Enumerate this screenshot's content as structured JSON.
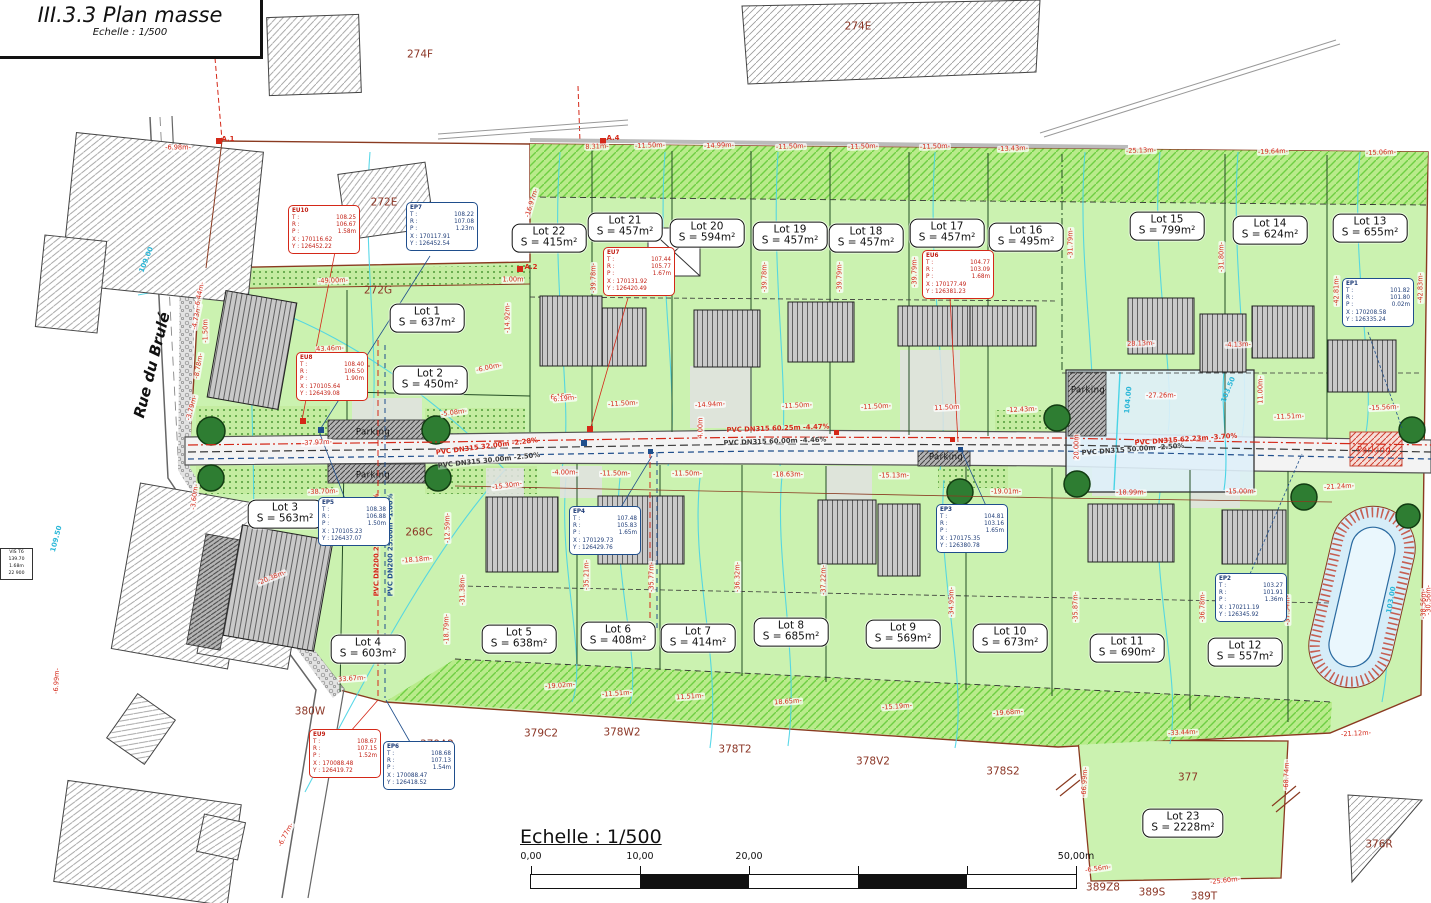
{
  "title_block": {
    "title": "III.3.3 Plan masse",
    "subtitle": "Echelle : 1/500"
  },
  "street": {
    "name": "Rue du Brulé"
  },
  "scale_bar": {
    "label": "Echelle : 1/500",
    "ticks": [
      {
        "t": "0,00",
        "p": 0
      },
      {
        "t": "10,00",
        "p": 109
      },
      {
        "t": "20,00",
        "p": 218
      },
      {
        "t": "50,00m",
        "p": 545
      }
    ]
  },
  "ref_box": {
    "lines": [
      "VIS T6",
      "139.70",
      "1.68m",
      "22 900"
    ]
  },
  "colors": {
    "lot_green": "#cbf2b0",
    "hatch_green": "#b9eb8b",
    "water": "#dff0f9",
    "red": "#d42818",
    "navy": "#1f4e8c",
    "parcel_brown": "#8b3525",
    "contour_cyan": "#49d4e6",
    "boundary": "#8a3a20"
  },
  "lots": [
    {
      "name": "Lot 1",
      "area": "S = 637m²",
      "x": 427,
      "y": 318
    },
    {
      "name": "Lot 2",
      "area": "S = 450m²",
      "x": 430,
      "y": 380
    },
    {
      "name": "Lot 3",
      "area": "S = 563m²",
      "x": 285,
      "y": 514
    },
    {
      "name": "Lot 4",
      "area": "S = 603m²",
      "x": 368,
      "y": 649
    },
    {
      "name": "Lot 5",
      "area": "S = 638m²",
      "x": 519,
      "y": 639
    },
    {
      "name": "Lot 6",
      "area": "S = 408m²",
      "x": 618,
      "y": 636
    },
    {
      "name": "Lot 7",
      "area": "S = 414m²",
      "x": 698,
      "y": 638
    },
    {
      "name": "Lot 8",
      "area": "S = 685m²",
      "x": 791,
      "y": 632
    },
    {
      "name": "Lot 9",
      "area": "S = 569m²",
      "x": 903,
      "y": 634
    },
    {
      "name": "Lot 10",
      "area": "S = 673m²",
      "x": 1010,
      "y": 638
    },
    {
      "name": "Lot 11",
      "area": "S = 690m²",
      "x": 1127,
      "y": 648
    },
    {
      "name": "Lot 12",
      "area": "S = 557m²",
      "x": 1245,
      "y": 652
    },
    {
      "name": "Lot 13",
      "area": "S = 655m²",
      "x": 1370,
      "y": 228
    },
    {
      "name": "Lot 14",
      "area": "S = 624m²",
      "x": 1270,
      "y": 230
    },
    {
      "name": "Lot 15",
      "area": "S = 799m²",
      "x": 1167,
      "y": 226
    },
    {
      "name": "Lot 16",
      "area": "S = 495m²",
      "x": 1026,
      "y": 237
    },
    {
      "name": "Lot 17",
      "area": "S = 457m²",
      "x": 947,
      "y": 233
    },
    {
      "name": "Lot 18",
      "area": "S = 457m²",
      "x": 866,
      "y": 238
    },
    {
      "name": "Lot 19",
      "area": "S = 457m²",
      "x": 790,
      "y": 236
    },
    {
      "name": "Lot 20",
      "area": "S = 594m²",
      "x": 707,
      "y": 233
    },
    {
      "name": "Lot 21",
      "area": "S = 457m²",
      "x": 625,
      "y": 227
    },
    {
      "name": "Lot 22",
      "area": "S = 415m²",
      "x": 549,
      "y": 238
    },
    {
      "name": "Lot 23",
      "area": "S = 2228m²",
      "x": 1183,
      "y": 823
    }
  ],
  "parcels": [
    {
      "t": "274F",
      "x": 420,
      "y": 55
    },
    {
      "t": "274E",
      "x": 858,
      "y": 27
    },
    {
      "t": "272E",
      "x": 384,
      "y": 203
    },
    {
      "t": "272G",
      "x": 378,
      "y": 291
    },
    {
      "t": "271L",
      "x": 357,
      "y": 364
    },
    {
      "t": "268C",
      "x": 419,
      "y": 533
    },
    {
      "t": "380W",
      "x": 310,
      "y": 712
    },
    {
      "t": "379A2",
      "x": 437,
      "y": 745
    },
    {
      "t": "379C2",
      "x": 541,
      "y": 734
    },
    {
      "t": "378W2",
      "x": 622,
      "y": 733
    },
    {
      "t": "378T2",
      "x": 735,
      "y": 750
    },
    {
      "t": "378V2",
      "x": 873,
      "y": 762
    },
    {
      "t": "378S2",
      "x": 1003,
      "y": 772
    },
    {
      "t": "377",
      "x": 1188,
      "y": 778
    },
    {
      "t": "389Z8",
      "x": 1103,
      "y": 888
    },
    {
      "t": "389S",
      "x": 1152,
      "y": 893
    },
    {
      "t": "389T",
      "x": 1204,
      "y": 897
    },
    {
      "t": "376R",
      "x": 1379,
      "y": 845
    }
  ],
  "survey_points": [
    {
      "id": "EU10",
      "kind": "eu",
      "x": 288,
      "y": 205,
      "T": "108.25",
      "R": "106.67",
      "P": "1.58m",
      "X": "170116.62",
      "Y": "126452.22"
    },
    {
      "id": "EP7",
      "kind": "ep",
      "x": 406,
      "y": 202,
      "T": "108.22",
      "R": "107.08",
      "P": "1.23m",
      "X": "170117.91",
      "Y": "126452.54"
    },
    {
      "id": "EU8",
      "kind": "eu",
      "x": 296,
      "y": 352,
      "T": "108.40",
      "R": "106.50",
      "P": "1.90m",
      "X": "170105.64",
      "Y": "126439.08"
    },
    {
      "id": "EU7",
      "kind": "eu",
      "x": 603,
      "y": 247,
      "T": "107.44",
      "R": "105.77",
      "P": "1.67m",
      "X": "170131.92",
      "Y": "126420.49"
    },
    {
      "id": "EU6",
      "kind": "eu",
      "x": 922,
      "y": 250,
      "T": "104.77",
      "R": "103.09",
      "P": "1.68m",
      "X": "170177.49",
      "Y": "126381.23"
    },
    {
      "id": "EP1",
      "kind": "ep",
      "x": 1342,
      "y": 278,
      "T": "101.82",
      "R": "101.80",
      "P": "0.02m",
      "X": "170208.58",
      "Y": "126335.24"
    },
    {
      "id": "EP5",
      "kind": "ep",
      "x": 318,
      "y": 497,
      "T": "108.38",
      "R": "106.88",
      "P": "1.50m",
      "X": "170105.23",
      "Y": "126437.07"
    },
    {
      "id": "EP4",
      "kind": "ep",
      "x": 569,
      "y": 506,
      "T": "107.48",
      "R": "105.83",
      "P": "1.65m",
      "X": "170129.73",
      "Y": "126429.76"
    },
    {
      "id": "EP3",
      "kind": "ep",
      "x": 936,
      "y": 504,
      "T": "104.81",
      "R": "103.16",
      "P": "1.65m",
      "X": "170175.35",
      "Y": "126380.78"
    },
    {
      "id": "EP2",
      "kind": "ep",
      "x": 1215,
      "y": 573,
      "T": "103.27",
      "R": "101.91",
      "P": "1.36m",
      "X": "170211.19",
      "Y": "126345.92"
    },
    {
      "id": "EU9",
      "kind": "eu",
      "x": 309,
      "y": 729,
      "T": "108.67",
      "R": "107.15",
      "P": "1.52m",
      "X": "170088.48",
      "Y": "126419.72"
    },
    {
      "id": "EP6",
      "kind": "ep",
      "x": 383,
      "y": 741,
      "T": "108.68",
      "R": "107.13",
      "P": "1.54m",
      "X": "170088.47",
      "Y": "126418.52"
    }
  ],
  "dimensions": [
    {
      "t": "-6.98m-",
      "x": 178,
      "y": 148,
      "r": 0
    },
    {
      "t": "8.31m-",
      "x": 597,
      "y": 147,
      "r": -2
    },
    {
      "t": "-11.50m-",
      "x": 650,
      "y": 146,
      "r": -2
    },
    {
      "t": "-14.99m-",
      "x": 719,
      "y": 146,
      "r": -2
    },
    {
      "t": "-11.50m-",
      "x": 791,
      "y": 147,
      "r": -2
    },
    {
      "t": "-11.50m-",
      "x": 863,
      "y": 147,
      "r": -2
    },
    {
      "t": "-11.50m-",
      "x": 935,
      "y": 147,
      "r": -2
    },
    {
      "t": "-13.43m-",
      "x": 1013,
      "y": 149,
      "r": -2
    },
    {
      "t": "-25.13m-",
      "x": 1141,
      "y": 151,
      "r": -2
    },
    {
      "t": "-19.64m-",
      "x": 1273,
      "y": 152,
      "r": -2
    },
    {
      "t": "-15.06m-",
      "x": 1381,
      "y": 153,
      "r": -2
    },
    {
      "t": "-49.00m-",
      "x": 333,
      "y": 281,
      "r": -2
    },
    {
      "t": "1.00m",
      "x": 513,
      "y": 280,
      "r": 0
    },
    {
      "t": "43.46m-",
      "x": 330,
      "y": 349,
      "r": -3
    },
    {
      "t": "-16.97m-",
      "x": 532,
      "y": 203,
      "r": -73
    },
    {
      "t": "-14.92m-",
      "x": 508,
      "y": 318,
      "r": -90
    },
    {
      "t": "-37.97m-",
      "x": 317,
      "y": 443,
      "r": -3
    },
    {
      "t": "-38.70m-",
      "x": 323,
      "y": 492,
      "r": -2
    },
    {
      "t": "-6.00m-",
      "x": 489,
      "y": 368,
      "r": -12
    },
    {
      "t": "6.15m",
      "x": 561,
      "y": 397,
      "r": -5
    },
    {
      "t": "-5.08m-",
      "x": 454,
      "y": 413,
      "r": -8
    },
    {
      "t": "-1.50m",
      "x": 206,
      "y": 331,
      "r": -90
    },
    {
      "t": "-4.73m-",
      "x": 197,
      "y": 317,
      "r": -78
    },
    {
      "t": "-6.44m-",
      "x": 200,
      "y": 295,
      "r": -78
    },
    {
      "t": "-8.78m-",
      "x": 199,
      "y": 366,
      "r": -80
    },
    {
      "t": "-3.79m-",
      "x": 192,
      "y": 408,
      "r": -75
    },
    {
      "t": "-3.60m-",
      "x": 195,
      "y": 497,
      "r": -83
    },
    {
      "t": "-6.99m-",
      "x": 57,
      "y": 681,
      "r": -87
    },
    {
      "t": "-6.77m-",
      "x": 286,
      "y": 835,
      "r": -62
    },
    {
      "t": "-15.30m-",
      "x": 507,
      "y": 486,
      "r": -8
    },
    {
      "t": "-4.00m-",
      "x": 565,
      "y": 473,
      "r": 0
    },
    {
      "t": "-11.50m-",
      "x": 615,
      "y": 474,
      "r": 0
    },
    {
      "t": "-11.50m-",
      "x": 687,
      "y": 474,
      "r": 0
    },
    {
      "t": "-18.63m-",
      "x": 788,
      "y": 475,
      "r": 0
    },
    {
      "t": "-15.13m-",
      "x": 894,
      "y": 476,
      "r": 0
    },
    {
      "t": "-19.01m-",
      "x": 1006,
      "y": 492,
      "r": 0
    },
    {
      "t": "-18.99m-",
      "x": 1131,
      "y": 493,
      "r": 0
    },
    {
      "t": "-15.00m-",
      "x": 1241,
      "y": 492,
      "r": 0
    },
    {
      "t": "6.19m-",
      "x": 565,
      "y": 399,
      "r": -5
    },
    {
      "t": "-11.50m-",
      "x": 623,
      "y": 404,
      "r": -3
    },
    {
      "t": "-14.94m-",
      "x": 710,
      "y": 405,
      "r": -3
    },
    {
      "t": "-11.50m-",
      "x": 797,
      "y": 406,
      "r": -3
    },
    {
      "t": "-11.50m-",
      "x": 876,
      "y": 407,
      "r": -3
    },
    {
      "t": "11.50m",
      "x": 947,
      "y": 408,
      "r": -3
    },
    {
      "t": "-12.43m-",
      "x": 1022,
      "y": 410,
      "r": -3
    },
    {
      "t": "4.00m",
      "x": 701,
      "y": 428,
      "r": -90
    },
    {
      "t": "-39.78m-",
      "x": 594,
      "y": 278,
      "r": -90
    },
    {
      "t": "-39.77m-",
      "x": 669,
      "y": 276,
      "r": -90
    },
    {
      "t": "-39.78m-",
      "x": 765,
      "y": 277,
      "r": -90
    },
    {
      "t": "-39.79m-",
      "x": 840,
      "y": 277,
      "r": -90
    },
    {
      "t": "-39.79m-",
      "x": 915,
      "y": 272,
      "r": -90
    },
    {
      "t": "-39.79m-",
      "x": 979,
      "y": 272,
      "r": -90
    },
    {
      "t": "-31.79m-",
      "x": 1071,
      "y": 243,
      "r": -90
    },
    {
      "t": "-31.80m-",
      "x": 1222,
      "y": 257,
      "r": -90
    },
    {
      "t": "-42.81m-",
      "x": 1337,
      "y": 291,
      "r": -90
    },
    {
      "t": "-42.83m-",
      "x": 1421,
      "y": 288,
      "r": -90
    },
    {
      "t": "-35.21m-",
      "x": 587,
      "y": 575,
      "r": -90
    },
    {
      "t": "-35.77m-",
      "x": 652,
      "y": 577,
      "r": -90
    },
    {
      "t": "-36.32m-",
      "x": 738,
      "y": 577,
      "r": -90
    },
    {
      "t": "-37.22m-",
      "x": 824,
      "y": 580,
      "r": -90
    },
    {
      "t": "-34.95m-",
      "x": 952,
      "y": 602,
      "r": -90
    },
    {
      "t": "-35.87m-",
      "x": 1076,
      "y": 607,
      "r": -90
    },
    {
      "t": "-36.78m-",
      "x": 1203,
      "y": 607,
      "r": -90
    },
    {
      "t": "-37.54m-",
      "x": 1288,
      "y": 610,
      "r": -90
    },
    {
      "t": "-38.56m-",
      "x": 1424,
      "y": 604,
      "r": -90
    },
    {
      "t": "-18.79m-",
      "x": 447,
      "y": 629,
      "r": -90
    },
    {
      "t": "-12.59m-",
      "x": 448,
      "y": 528,
      "r": -90
    },
    {
      "t": "-31.38m-",
      "x": 463,
      "y": 590,
      "r": -90
    },
    {
      "t": "-18.18m-",
      "x": 417,
      "y": 560,
      "r": -5
    },
    {
      "t": "-20.38m-",
      "x": 272,
      "y": 578,
      "r": -22
    },
    {
      "t": "33.67m-",
      "x": 352,
      "y": 679,
      "r": -4
    },
    {
      "t": "-19.02m-",
      "x": 560,
      "y": 686,
      "r": -4
    },
    {
      "t": "-11.51m-",
      "x": 617,
      "y": 694,
      "r": -4
    },
    {
      "t": "11.51m-",
      "x": 690,
      "y": 697,
      "r": -4
    },
    {
      "t": "18.65m-",
      "x": 788,
      "y": 702,
      "r": -4
    },
    {
      "t": "-15.19m-",
      "x": 897,
      "y": 707,
      "r": -4
    },
    {
      "t": "-19.68m-",
      "x": 1008,
      "y": 713,
      "r": -4
    },
    {
      "t": "-33.44m-",
      "x": 1183,
      "y": 733,
      "r": -3
    },
    {
      "t": "-21.12m-",
      "x": 1356,
      "y": 734,
      "r": -3
    },
    {
      "t": "-66.99m-",
      "x": 1085,
      "y": 782,
      "r": -87
    },
    {
      "t": "-68.74m-",
      "x": 1287,
      "y": 775,
      "r": -88
    },
    {
      "t": "-6.56m-",
      "x": 1098,
      "y": 869,
      "r": -8
    },
    {
      "t": "-25.60m-",
      "x": 1225,
      "y": 881,
      "r": -6
    },
    {
      "t": "-27.26m-",
      "x": 1161,
      "y": 396,
      "r": 0
    },
    {
      "t": "20.00m",
      "x": 1077,
      "y": 447,
      "r": -90
    },
    {
      "t": "28.13m-",
      "x": 1141,
      "y": 344,
      "r": -2
    },
    {
      "t": "-4.13m-",
      "x": 1238,
      "y": 345,
      "r": -2
    },
    {
      "t": "11.00m-",
      "x": 1261,
      "y": 390,
      "r": -90
    },
    {
      "t": "-11.51m-",
      "x": 1289,
      "y": 417,
      "r": -2
    },
    {
      "t": "-21.24m-",
      "x": 1339,
      "y": 487,
      "r": -3
    },
    {
      "t": "-30.56m-",
      "x": 1429,
      "y": 600,
      "r": -90
    },
    {
      "t": "-15.56m-",
      "x": 1384,
      "y": 408,
      "r": -3
    }
  ],
  "pipe_labels": [
    {
      "t": "PVC DN315  32.00m   -2.28%",
      "x": 487,
      "y": 447,
      "r": -7,
      "c": "red"
    },
    {
      "t": "PVC DN315  30.00m   -2.50%",
      "x": 489,
      "y": 461,
      "r": -6,
      "c": "dark"
    },
    {
      "t": "PVC DN315  60.25m   -4.47%",
      "x": 778,
      "y": 429,
      "r": -2,
      "c": "red"
    },
    {
      "t": "PVC DN315  60.00m   -4.46%",
      "x": 775,
      "y": 442,
      "r": -2,
      "c": "dark"
    },
    {
      "t": "PVC DN315  62.23m   -3.70%",
      "x": 1186,
      "y": 440,
      "r": -4,
      "c": "red"
    },
    {
      "t": "PVC DN315  50.00m   -2.50%",
      "x": 1133,
      "y": 450,
      "r": -4,
      "c": "dark"
    },
    {
      "t": "PVC DN200  25.00m   -3.02%",
      "x": 377,
      "y": 545,
      "r": -90,
      "c": "red"
    },
    {
      "t": "PVC DN200  25.00m   -1.00%",
      "x": 391,
      "y": 545,
      "r": -90,
      "c": "navy"
    }
  ],
  "contour_labels": [
    {
      "t": "109.00",
      "x": 147,
      "y": 260,
      "r": -68
    },
    {
      "t": "109.50",
      "x": 57,
      "y": 539,
      "r": -75
    },
    {
      "t": "104.00",
      "x": 1129,
      "y": 400,
      "r": -85
    },
    {
      "t": "103.50",
      "x": 1229,
      "y": 390,
      "r": -68
    },
    {
      "t": "103.00",
      "x": 1392,
      "y": 600,
      "r": -80
    }
  ],
  "parking_labels": [
    {
      "t": "Parking",
      "x": 373,
      "y": 433,
      "c": ""
    },
    {
      "t": "Parking",
      "x": 373,
      "y": 476,
      "c": ""
    },
    {
      "t": "Parking",
      "x": 946,
      "y": 458,
      "c": ""
    },
    {
      "t": "Parking",
      "x": 1088,
      "y": 391,
      "c": ""
    },
    {
      "t": "Parking",
      "x": 1374,
      "y": 451,
      "c": "red"
    }
  ],
  "markers": [
    {
      "t": "A.1",
      "x": 228,
      "y": 140
    },
    {
      "t": "A.2",
      "x": 531,
      "y": 268
    },
    {
      "t": "A.4",
      "x": 613,
      "y": 139
    }
  ]
}
